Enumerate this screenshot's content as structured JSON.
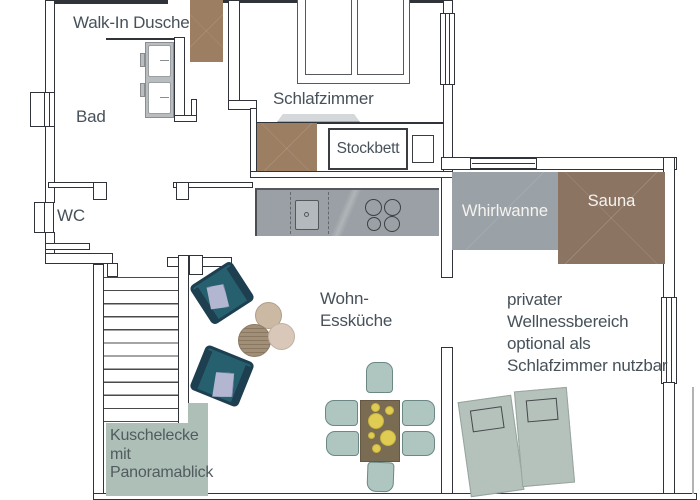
{
  "labels": {
    "walk_in_dusche": "Walk-In Dusche",
    "bad": "Bad",
    "wc": "WC",
    "schlafzimmer": "Schlafzimmer",
    "stockbett": "Stockbett",
    "whirlwanne": "Whirlwanne",
    "sauna": "Sauna",
    "wohn_esskueche": {
      "lines": [
        "Wohn-",
        "Essküche"
      ]
    },
    "kuschelecke": {
      "lines": [
        "Kuschelecke",
        "mit",
        "Panoramablick"
      ]
    },
    "wellnessbereich": {
      "lines": [
        "privater",
        "Wellnessbereich",
        "optional als",
        "Schlafzimmer nutzbar"
      ]
    }
  },
  "colors": {
    "wall": "#30333a",
    "text": "#47515a",
    "wood_brown": "#9c7e63",
    "sauna_brown": "#8b7462",
    "whirlpool_gray": "#9aa2a7",
    "kitchen_gray": "#9aa0a5",
    "sage_green": "#aebfb8",
    "lounger_sage": "#b5c1bb",
    "armchair_teal": "#26606e",
    "cushion_lavender": "#b2b6d1",
    "plate_yellow": "#e0cc52",
    "table_brown": "#7a6b53"
  }
}
